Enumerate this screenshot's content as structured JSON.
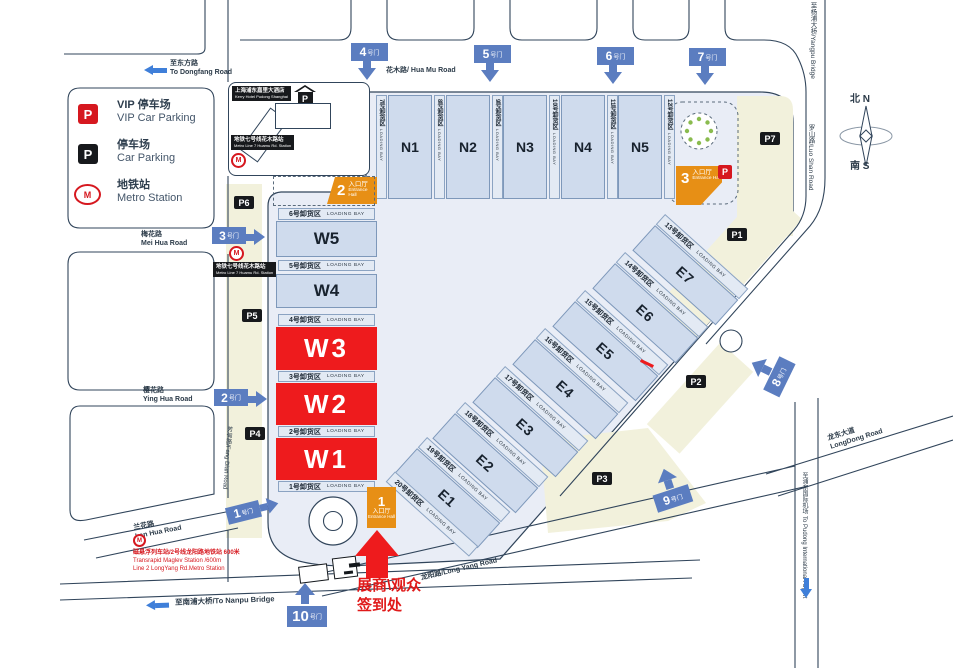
{
  "legend": {
    "vip_zh": "VIP 停车场",
    "vip_en": "VIP Car Parking",
    "park_zh": "停车场",
    "park_en": "Car Parking",
    "metro_zh": "地铁站",
    "metro_en": "Metro Station"
  },
  "parking": {
    "p": "P",
    "m": "M",
    "tags": [
      "P1",
      "P2",
      "P3",
      "P4",
      "P5",
      "P6",
      "P7"
    ]
  },
  "halls": {
    "n": [
      "N1",
      "N2",
      "N3",
      "N4",
      "N5"
    ],
    "w": [
      "W5",
      "W4",
      "W3",
      "W2",
      "W1"
    ],
    "e": [
      "E7",
      "E6",
      "E5",
      "E4",
      "E3",
      "E2",
      "E1"
    ]
  },
  "bays": {
    "en": "LOADING BAY",
    "w": [
      "6号卸货区",
      "5号卸货区",
      "4号卸货区",
      "3号卸货区",
      "2号卸货区",
      "1号卸货区"
    ],
    "n": [
      "7号卸货区",
      "8号卸货区",
      "9号卸货区",
      "10号卸货区",
      "11号卸货区",
      "12号卸货区"
    ],
    "e": [
      "13号卸货区",
      "14号卸货区",
      "15号卸货区",
      "16号卸货区",
      "17号卸货区",
      "18号卸货区",
      "19号卸货区",
      "20号卸货区"
    ]
  },
  "gates": {
    "suffix": "号门",
    "nums": [
      "1",
      "2",
      "3",
      "4",
      "5",
      "6",
      "7",
      "8",
      "9",
      "10"
    ]
  },
  "entrances": {
    "zh": "入口厅",
    "en": "Entrance Hall",
    "nums": [
      "1",
      "2",
      "3"
    ]
  },
  "roads": {
    "dongfang_zh": "至东方路",
    "dongfang_en": "To Dongfang Road",
    "huamu": "花木路/ Hua Mu Road",
    "meihua_zh": "梅花路",
    "meihua_en": "Mei Hua Road",
    "yinghua_zh": "樱花路",
    "yinghua_en": "Ying Hua Road",
    "lanhua_zh": "兰花路",
    "lanhua_en": "Lan Hua Road",
    "nanpu": "至南浦大桥/To Nanpu Bridge",
    "longyang": "龙阳路/Long Yang Road",
    "longdong_zh": "龙东大道",
    "longdong_en": "LongDong Road",
    "airport_zh": "至浦东国际机场",
    "airport_en": "To Pudong International Airport",
    "luoshan": "罗山路/Luo Shan Road",
    "yangpu": "至杨浦大桥/Yangpu Bridge",
    "fangdian": "芳甸路/Fang Dian Road"
  },
  "maglev": {
    "l1": "磁悬浮列车站/2号线龙阳路地铁站  600米",
    "l2": "Transrapid Maglev Station  /600m",
    "l3": "Line 2 LongYang Rd.Metro Station"
  },
  "kerry": {
    "zh": "上海浦东嘉里大酒店",
    "en": "Kerry Hotel Pudong Shanghai"
  },
  "metro7": {
    "zh": "地铁七号线花木路站",
    "en": "Metro Line 7  Huamu Rd.  Station"
  },
  "checkin": {
    "l1": "展商\\观众",
    "l2": "签到处"
  },
  "compass": {
    "n_zh": "北",
    "n_en": "N",
    "s_zh": "南",
    "s_en": "S"
  }
}
